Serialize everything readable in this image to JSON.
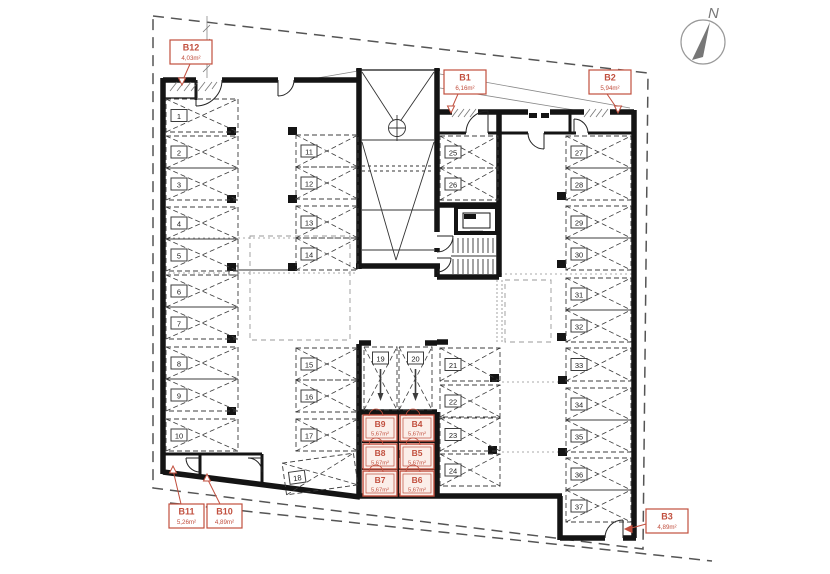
{
  "compass": {
    "label": "N"
  },
  "colors": {
    "accent": "#c14f3e",
    "accent_fill": "#fbeee9",
    "wall": "#141414",
    "line": "#3c3c3c",
    "muted": "#999999",
    "number_text": "#1a1a1a"
  },
  "parking_spaces": [
    {
      "n": "1",
      "x": 166,
      "y": 99,
      "w": 72,
      "h": 33
    },
    {
      "n": "2",
      "x": 166,
      "y": 136,
      "w": 72,
      "h": 32
    },
    {
      "n": "3",
      "x": 166,
      "y": 168,
      "w": 72,
      "h": 32
    },
    {
      "n": "4",
      "x": 166,
      "y": 207,
      "w": 72,
      "h": 32
    },
    {
      "n": "5",
      "x": 166,
      "y": 239,
      "w": 72,
      "h": 32
    },
    {
      "n": "6",
      "x": 166,
      "y": 275,
      "w": 72,
      "h": 32
    },
    {
      "n": "7",
      "x": 166,
      "y": 307,
      "w": 72,
      "h": 32
    },
    {
      "n": "8",
      "x": 166,
      "y": 347,
      "w": 72,
      "h": 32
    },
    {
      "n": "9",
      "x": 166,
      "y": 379,
      "w": 72,
      "h": 32
    },
    {
      "n": "10",
      "x": 166,
      "y": 419,
      "w": 72,
      "h": 32
    },
    {
      "n": "11",
      "x": 296,
      "y": 135,
      "w": 62,
      "h": 32
    },
    {
      "n": "12",
      "x": 296,
      "y": 167,
      "w": 62,
      "h": 32
    },
    {
      "n": "13",
      "x": 296,
      "y": 206,
      "w": 62,
      "h": 32
    },
    {
      "n": "14",
      "x": 296,
      "y": 238,
      "w": 62,
      "h": 32
    },
    {
      "n": "15",
      "x": 296,
      "y": 348,
      "w": 62,
      "h": 32
    },
    {
      "n": "16",
      "x": 296,
      "y": 380,
      "w": 62,
      "h": 32
    },
    {
      "n": "17",
      "x": 296,
      "y": 419,
      "w": 62,
      "h": 32
    },
    {
      "n": "18",
      "x": 284,
      "y": 458,
      "w": 72,
      "h": 32,
      "rot": -8
    },
    {
      "n": "19",
      "x": 364,
      "y": 347,
      "w": 33,
      "h": 63,
      "vert": true
    },
    {
      "n": "20",
      "x": 399,
      "y": 347,
      "w": 33,
      "h": 63,
      "vert": true
    },
    {
      "n": "21",
      "x": 440,
      "y": 348,
      "w": 60,
      "h": 33
    },
    {
      "n": "22",
      "x": 440,
      "y": 385,
      "w": 60,
      "h": 32
    },
    {
      "n": "23",
      "x": 440,
      "y": 418,
      "w": 60,
      "h": 33
    },
    {
      "n": "24",
      "x": 440,
      "y": 454,
      "w": 60,
      "h": 32
    },
    {
      "n": "25",
      "x": 440,
      "y": 136,
      "w": 58,
      "h": 32
    },
    {
      "n": "26",
      "x": 440,
      "y": 168,
      "w": 58,
      "h": 32
    },
    {
      "n": "27",
      "x": 566,
      "y": 136,
      "w": 65,
      "h": 32
    },
    {
      "n": "28",
      "x": 566,
      "y": 168,
      "w": 65,
      "h": 32
    },
    {
      "n": "29",
      "x": 566,
      "y": 206,
      "w": 65,
      "h": 32
    },
    {
      "n": "30",
      "x": 566,
      "y": 238,
      "w": 65,
      "h": 32
    },
    {
      "n": "31",
      "x": 566,
      "y": 278,
      "w": 65,
      "h": 32
    },
    {
      "n": "32",
      "x": 566,
      "y": 310,
      "w": 65,
      "h": 32
    },
    {
      "n": "33",
      "x": 566,
      "y": 348,
      "w": 65,
      "h": 33
    },
    {
      "n": "34",
      "x": 566,
      "y": 388,
      "w": 65,
      "h": 32
    },
    {
      "n": "35",
      "x": 566,
      "y": 420,
      "w": 65,
      "h": 32
    },
    {
      "n": "36",
      "x": 566,
      "y": 458,
      "w": 65,
      "h": 32
    },
    {
      "n": "37",
      "x": 566,
      "y": 490,
      "w": 65,
      "h": 32
    }
  ],
  "storage_cells": [
    {
      "id": "B9",
      "area": "5,67m²",
      "x": 363,
      "y": 415,
      "w": 34,
      "h": 26
    },
    {
      "id": "B4",
      "area": "5,67m²",
      "x": 400,
      "y": 415,
      "w": 34,
      "h": 26
    },
    {
      "id": "B8",
      "area": "5,67m²",
      "x": 363,
      "y": 444,
      "w": 34,
      "h": 25
    },
    {
      "id": "B5",
      "area": "5,67m²",
      "x": 400,
      "y": 444,
      "w": 34,
      "h": 25
    },
    {
      "id": "B7",
      "area": "5,67m²",
      "x": 363,
      "y": 471,
      "w": 34,
      "h": 25
    },
    {
      "id": "B6",
      "area": "5,67m²",
      "x": 400,
      "y": 471,
      "w": 34,
      "h": 25
    }
  ],
  "storage_labels": [
    {
      "id": "B12",
      "area": "4,03m²",
      "bx": 170,
      "by": 40,
      "bw": 42,
      "lx1": 190,
      "ly1": 64,
      "lx2": 182,
      "ly2": 82,
      "ax": 182,
      "ay": 85,
      "dir": "down",
      "style": "hollow"
    },
    {
      "id": "B1",
      "area": "6,16m²",
      "bx": 444,
      "by": 70,
      "bw": 42,
      "lx1": 458,
      "ly1": 94,
      "lx2": 451,
      "ly2": 110,
      "ax": 451,
      "ay": 113,
      "dir": "down",
      "style": "hollow"
    },
    {
      "id": "B2",
      "area": "5,94m²",
      "bx": 589,
      "by": 70,
      "bw": 42,
      "lx1": 607,
      "ly1": 94,
      "lx2": 618,
      "ly2": 110,
      "ax": 618,
      "ay": 113,
      "dir": "down",
      "style": "hollow"
    },
    {
      "id": "B3",
      "area": "4,89m²",
      "bx": 646,
      "by": 509,
      "bw": 42,
      "lx1": 646,
      "ly1": 524,
      "lx2": 628,
      "ly2": 529,
      "ax": 625,
      "ay": 529,
      "dir": "left",
      "style": "filled"
    },
    {
      "id": "B11",
      "area": "5,26m²",
      "bx": 169,
      "by": 504,
      "bw": 35,
      "lx1": 181,
      "ly1": 504,
      "lx2": 173,
      "ly2": 470,
      "ax": 173,
      "ay": 466,
      "dir": "up",
      "style": "hollow"
    },
    {
      "id": "B10",
      "area": "4,89m²",
      "bx": 207,
      "by": 504,
      "bw": 35,
      "lx1": 220,
      "ly1": 504,
      "lx2": 207,
      "ly2": 478,
      "ax": 207,
      "ay": 474,
      "dir": "up",
      "style": "hollow"
    }
  ]
}
